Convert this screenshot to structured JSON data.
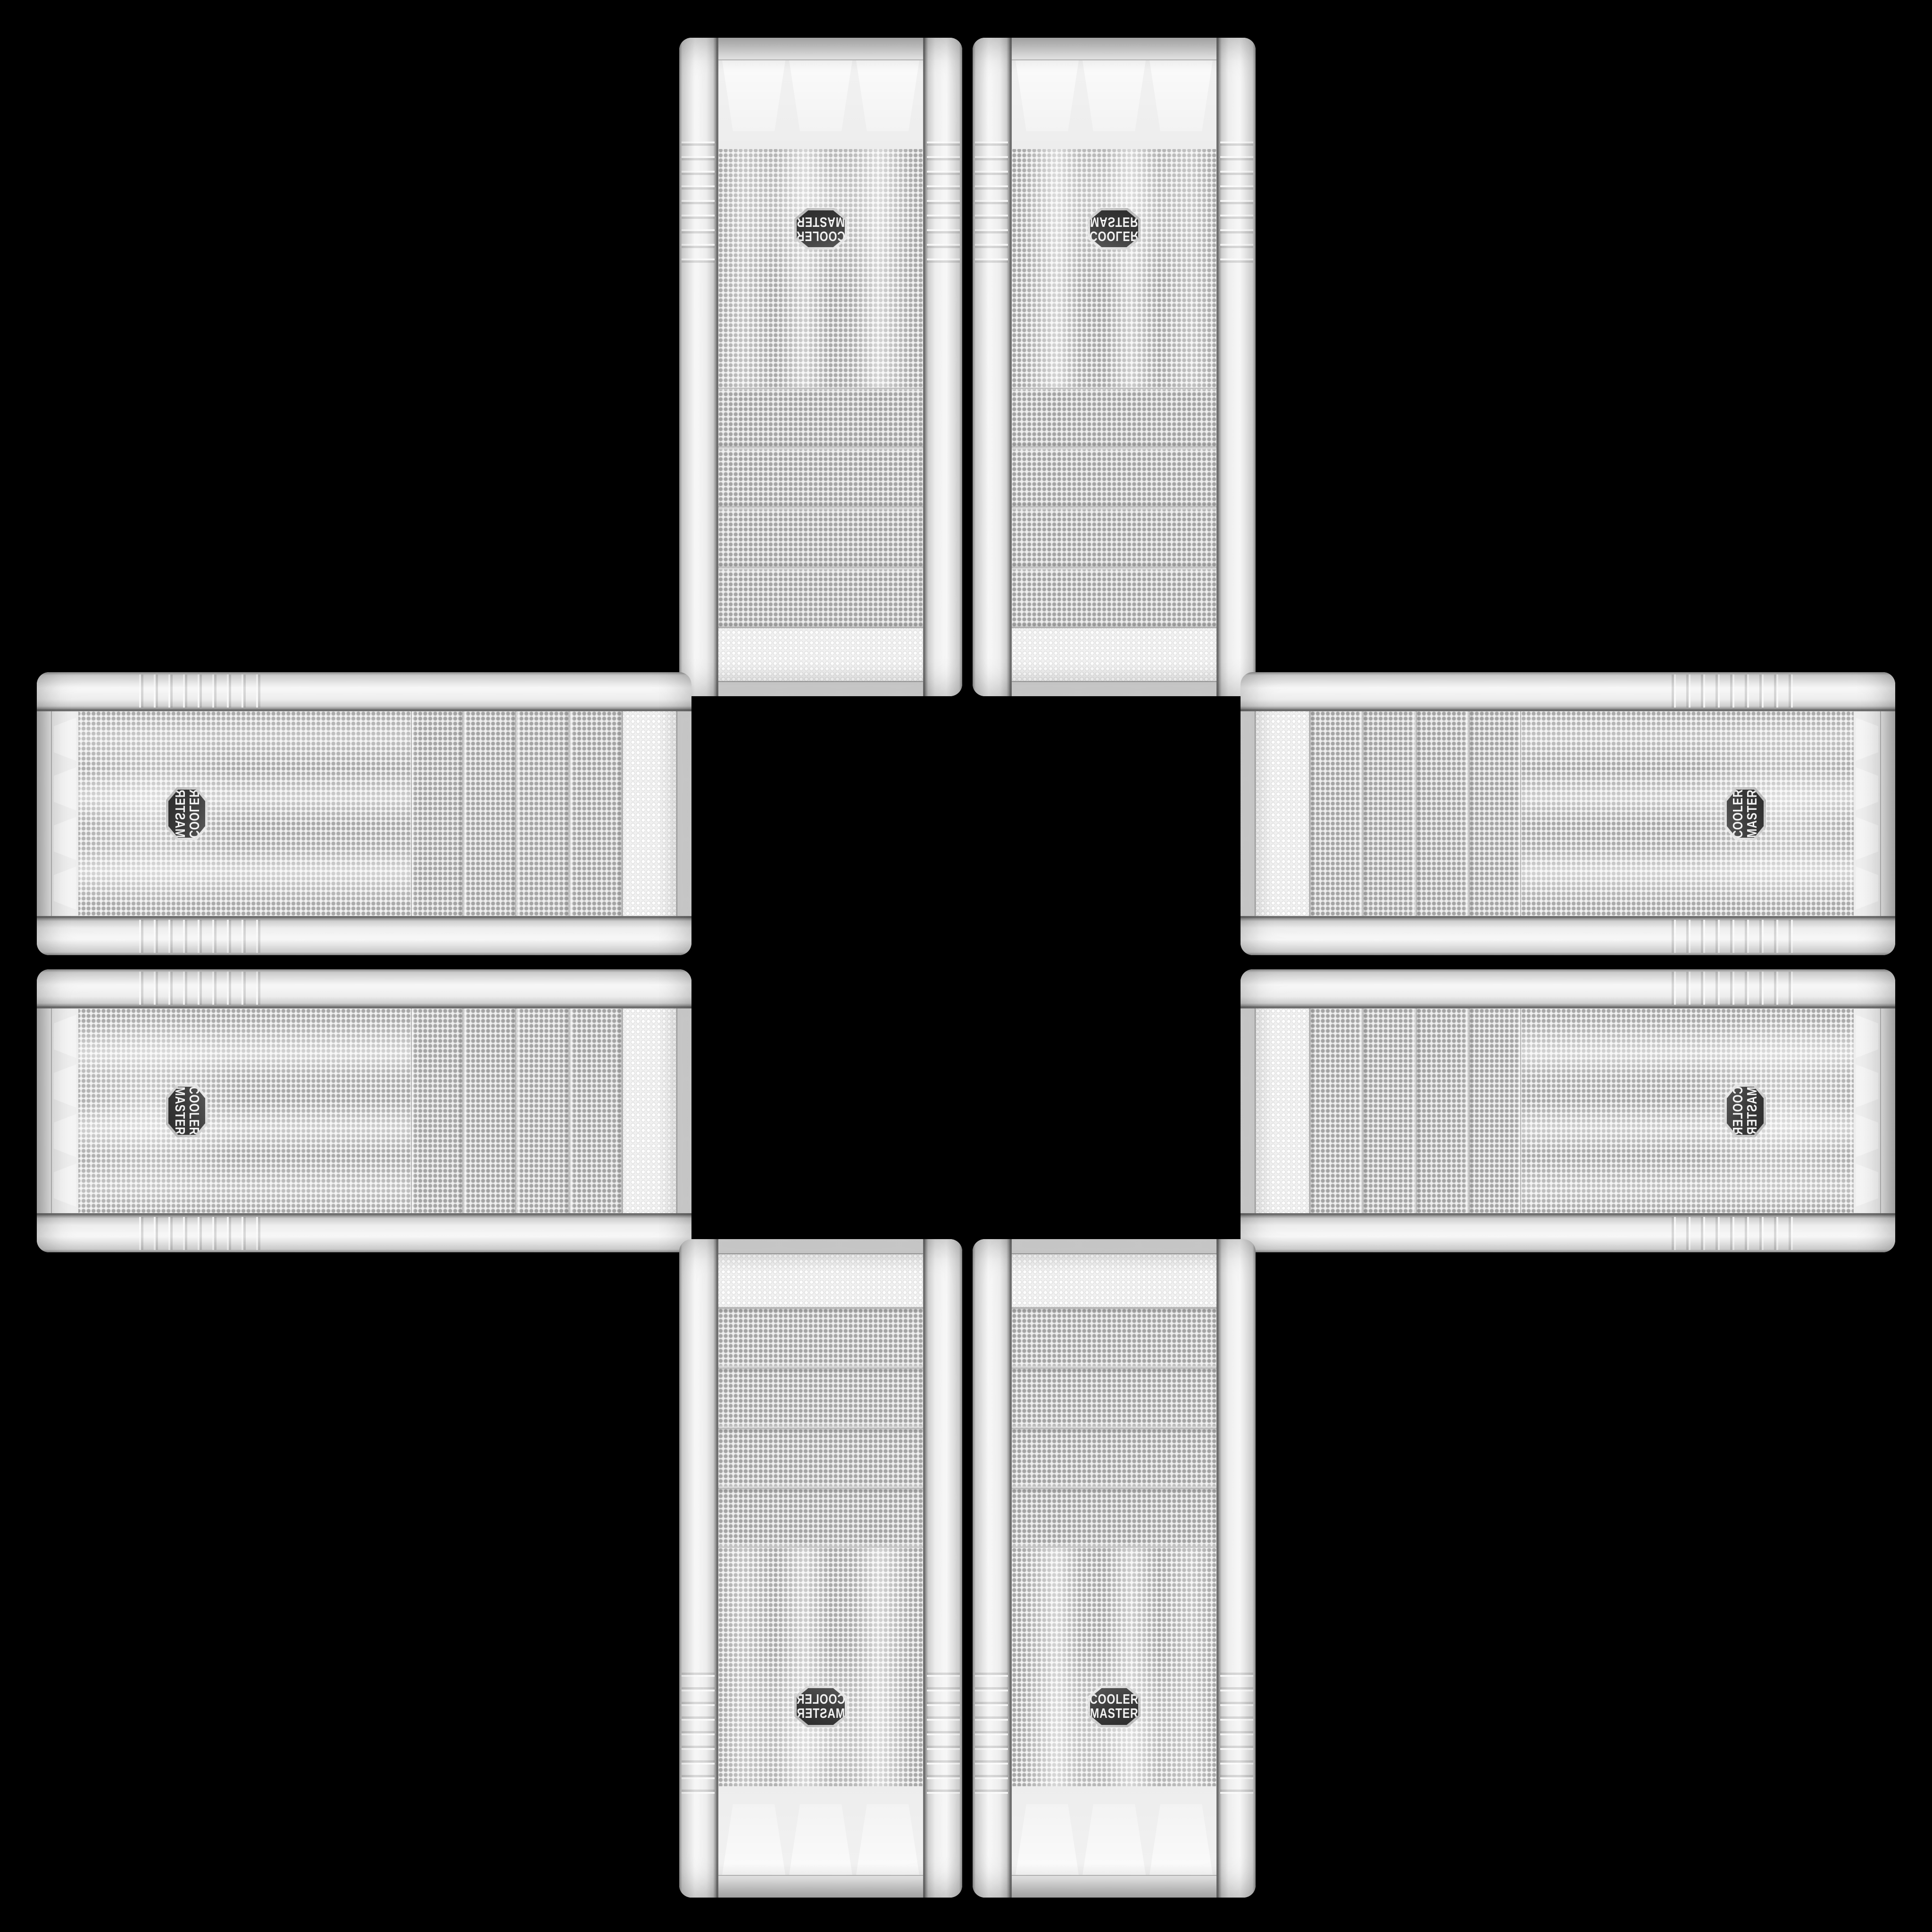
{
  "scene": {
    "description": "Eight identical white Cooler Master mesh-front mid-tower PC cases arranged front-panel-up in a plus/cross pattern on a black background, two cases per arm, feet bezels pointing outward",
    "background_color": "#000000"
  },
  "badge": {
    "line1": "COOLER",
    "line2": "MASTER",
    "background": "#3a3a3a",
    "rim": "#d6d6d6",
    "text_color": "#f2f2f2"
  },
  "palette": {
    "case_body": "#ededed",
    "rail_highlight": "#fbfbfb",
    "rail_shadow": "#9a9a9a",
    "mesh_base": "#f2f2f2",
    "mesh_dot_dark": "#a8a8a8",
    "mesh_dot_light": "#c9c9c9",
    "emboss_dot": "#ffffff",
    "seam_silver": "#bfbfbf",
    "seam_dark": "#6f6f6f"
  },
  "cases": [
    {
      "id": "top-left",
      "orientation": "vertical",
      "feet_end": "up",
      "badge_text_orientation": "rotated-180"
    },
    {
      "id": "top-right",
      "orientation": "vertical",
      "feet_end": "up",
      "badge_text_orientation": "flipped-vertical"
    },
    {
      "id": "left-top",
      "orientation": "horizontal",
      "feet_end": "left",
      "badge_text_orientation": "rotated-90-mirrored"
    },
    {
      "id": "left-bottom",
      "orientation": "horizontal",
      "feet_end": "left",
      "badge_text_orientation": "rotated-90"
    },
    {
      "id": "right-top",
      "orientation": "horizontal",
      "feet_end": "right",
      "badge_text_orientation": "rotated-270"
    },
    {
      "id": "right-bottom",
      "orientation": "horizontal",
      "feet_end": "right",
      "badge_text_orientation": "rotated-270-mirrored"
    },
    {
      "id": "bottom-left",
      "orientation": "vertical",
      "feet_end": "down",
      "badge_text_orientation": "mirrored-horizontal"
    },
    {
      "id": "bottom-right",
      "orientation": "vertical",
      "feet_end": "down",
      "badge_text_orientation": "upright"
    }
  ]
}
